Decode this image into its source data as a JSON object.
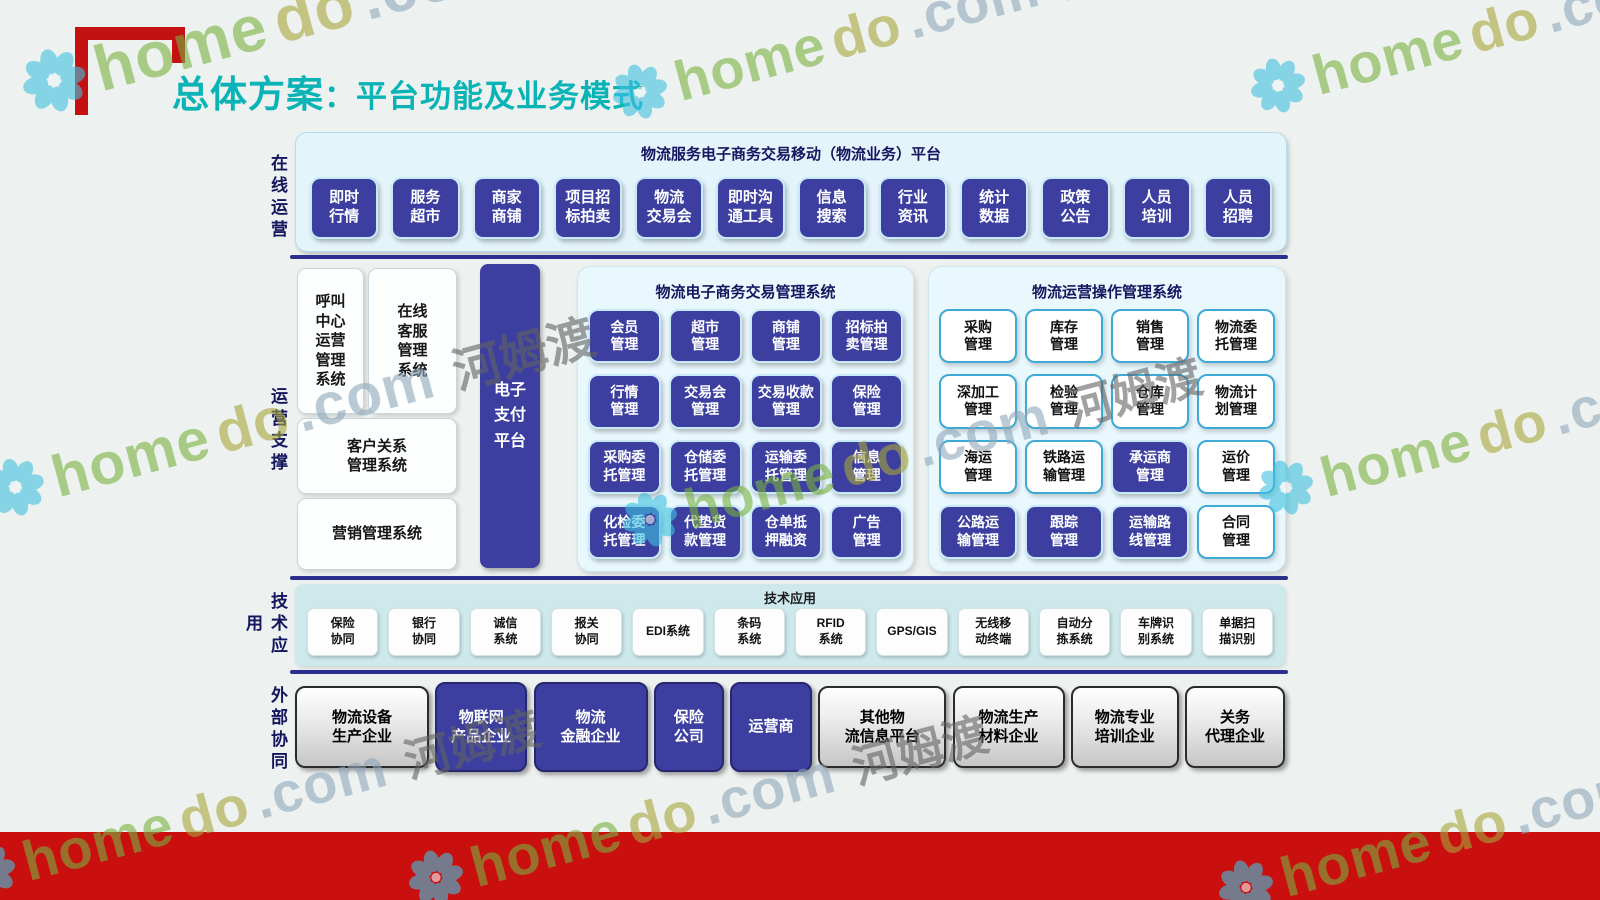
{
  "header": {
    "title_main": "总体方案",
    "title_sub": "：平台功能及业务模式"
  },
  "watermark": {
    "home": "home",
    "do": "do",
    "com": ".com",
    "cn": "河姆渡",
    "flower_color": "#3fc1e1"
  },
  "colors": {
    "accent_teal": "#0ab3b5",
    "box_navy": "#3c3f9f",
    "divider_navy": "#2c2e8e",
    "footer_red": "#ca0f0f",
    "bracket_red": "#c41212"
  },
  "rows": {
    "online": {
      "side_label": "在线运营",
      "panel_title": "物流服务电子商务交易移动（物流业务）平台",
      "buttons": [
        "即时\n行情",
        "服务\n超市",
        "商家\n商铺",
        "项目招\n标拍卖",
        "物流\n交易会",
        "即时沟\n通工具",
        "信息\n搜索",
        "行业\n资讯",
        "统计\n数据",
        "政策\n公告",
        "人员\n培训",
        "人员\n招聘"
      ]
    },
    "support": {
      "side_label": "运营支撑",
      "left_boxes": [
        "呼叫\n中心\n运营\n管理\n系统",
        "在线\n客服\n管理\n系统",
        "客户关系\n管理系统",
        "营销管理系统"
      ],
      "payment": "电子\n支付\n平台",
      "ecommerce": {
        "title": "物流电子商务交易管理系统",
        "buttons": [
          "会员\n管理",
          "超市\n管理",
          "商铺\n管理",
          "招标拍\n卖管理",
          "行情\n管理",
          "交易会\n管理",
          "交易收款\n管理",
          "保险\n管理",
          "采购委\n托管理",
          "仓储委\n托管理",
          "运输委\n托管理",
          "信息\n管理",
          "化检委\n托管理",
          "代垫货\n款管理",
          "仓单抵\n押融资",
          "广告\n管理"
        ]
      },
      "operation": {
        "title": "物流运营操作管理系统",
        "buttons": [
          {
            "label": "采购\n管理",
            "style": "light"
          },
          {
            "label": "库存\n管理",
            "style": "light"
          },
          {
            "label": "销售\n管理",
            "style": "light"
          },
          {
            "label": "物流委\n托管理",
            "style": "light"
          },
          {
            "label": "深加工\n管理",
            "style": "light"
          },
          {
            "label": "检验\n管理",
            "style": "light"
          },
          {
            "label": "仓库\n管理",
            "style": "light"
          },
          {
            "label": "物流计\n划管理",
            "style": "light"
          },
          {
            "label": "海运\n管理",
            "style": "light"
          },
          {
            "label": "铁路运\n输管理",
            "style": "light"
          },
          {
            "label": "承运商\n管理",
            "style": "dark"
          },
          {
            "label": "运价\n管理",
            "style": "light"
          },
          {
            "label": "公路运\n输管理",
            "style": "dark"
          },
          {
            "label": "跟踪\n管理",
            "style": "dark"
          },
          {
            "label": "运输路\n线管理",
            "style": "dark"
          },
          {
            "label": "合同\n管理",
            "style": "light"
          }
        ]
      }
    },
    "tech": {
      "side_label": "技术应用",
      "band_title": "技术应用",
      "buttons": [
        "保险\n协同",
        "银行\n协同",
        "诚信\n系统",
        "报关\n协同",
        "EDI系统",
        "条码\n系统",
        "RFID\n系统",
        "GPS/GIS",
        "无线移\n动终端",
        "自动分\n拣系统",
        "车牌识\n别系统",
        "单据扫\n描识别"
      ]
    },
    "external": {
      "side_label": "外部协同",
      "boxes": [
        {
          "label": "物流设备\n生产企业",
          "style": "gray"
        },
        {
          "label": "物联网\n产品企业",
          "style": "dark"
        },
        {
          "label": "物流\n金融企业",
          "style": "dark"
        },
        {
          "label": "保险\n公司",
          "style": "dark"
        },
        {
          "label": "运营商",
          "style": "dark"
        },
        {
          "label": "其他物\n流信息平台",
          "style": "gray"
        },
        {
          "label": "物流生产\n材料企业",
          "style": "gray"
        },
        {
          "label": "物流专业\n培训企业",
          "style": "gray"
        },
        {
          "label": "关务\n代理企业",
          "style": "gray"
        }
      ]
    }
  }
}
